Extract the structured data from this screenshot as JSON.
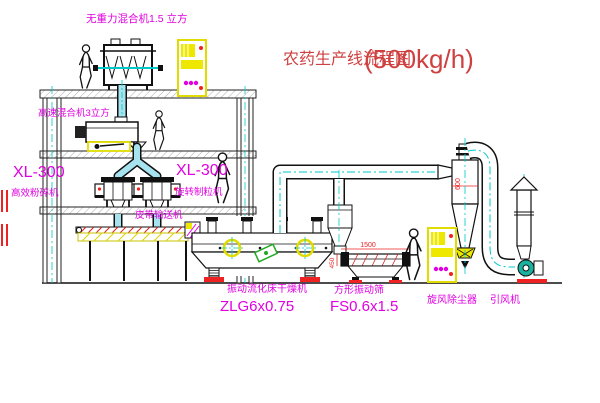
{
  "title": {
    "name": "农药生产线流程图",
    "capacity": "(500kg/h)"
  },
  "labels": {
    "top_mixer": "无重力混合机1.5 立方",
    "second_mixer": "高速混合机3立方",
    "crusher_model": "XL-300",
    "crusher": "高效粉碎机",
    "granulator_model": "XL-300",
    "granulator": "旋转制粒机",
    "belt": "皮带输送机",
    "dryer": "振动流化床干燥机",
    "dryer_model": "ZLG6x0.75",
    "sieve": "方形振动筛",
    "sieve_model": "FS0.6x1.5",
    "cyclone": "旋风除尘器",
    "fan": "引风机"
  },
  "dims": {
    "cyclone_diameter": "600",
    "sieve_length": "1500",
    "sieve_height": "450"
  },
  "colors": {
    "label_magenta": "#e000e0",
    "title_red": "#cf4040",
    "cad_cyan": "#00c8c8",
    "cad_yellow": "#eee800",
    "pipe_fill": "#a6e3ef",
    "dim_red": "#ee2222"
  }
}
